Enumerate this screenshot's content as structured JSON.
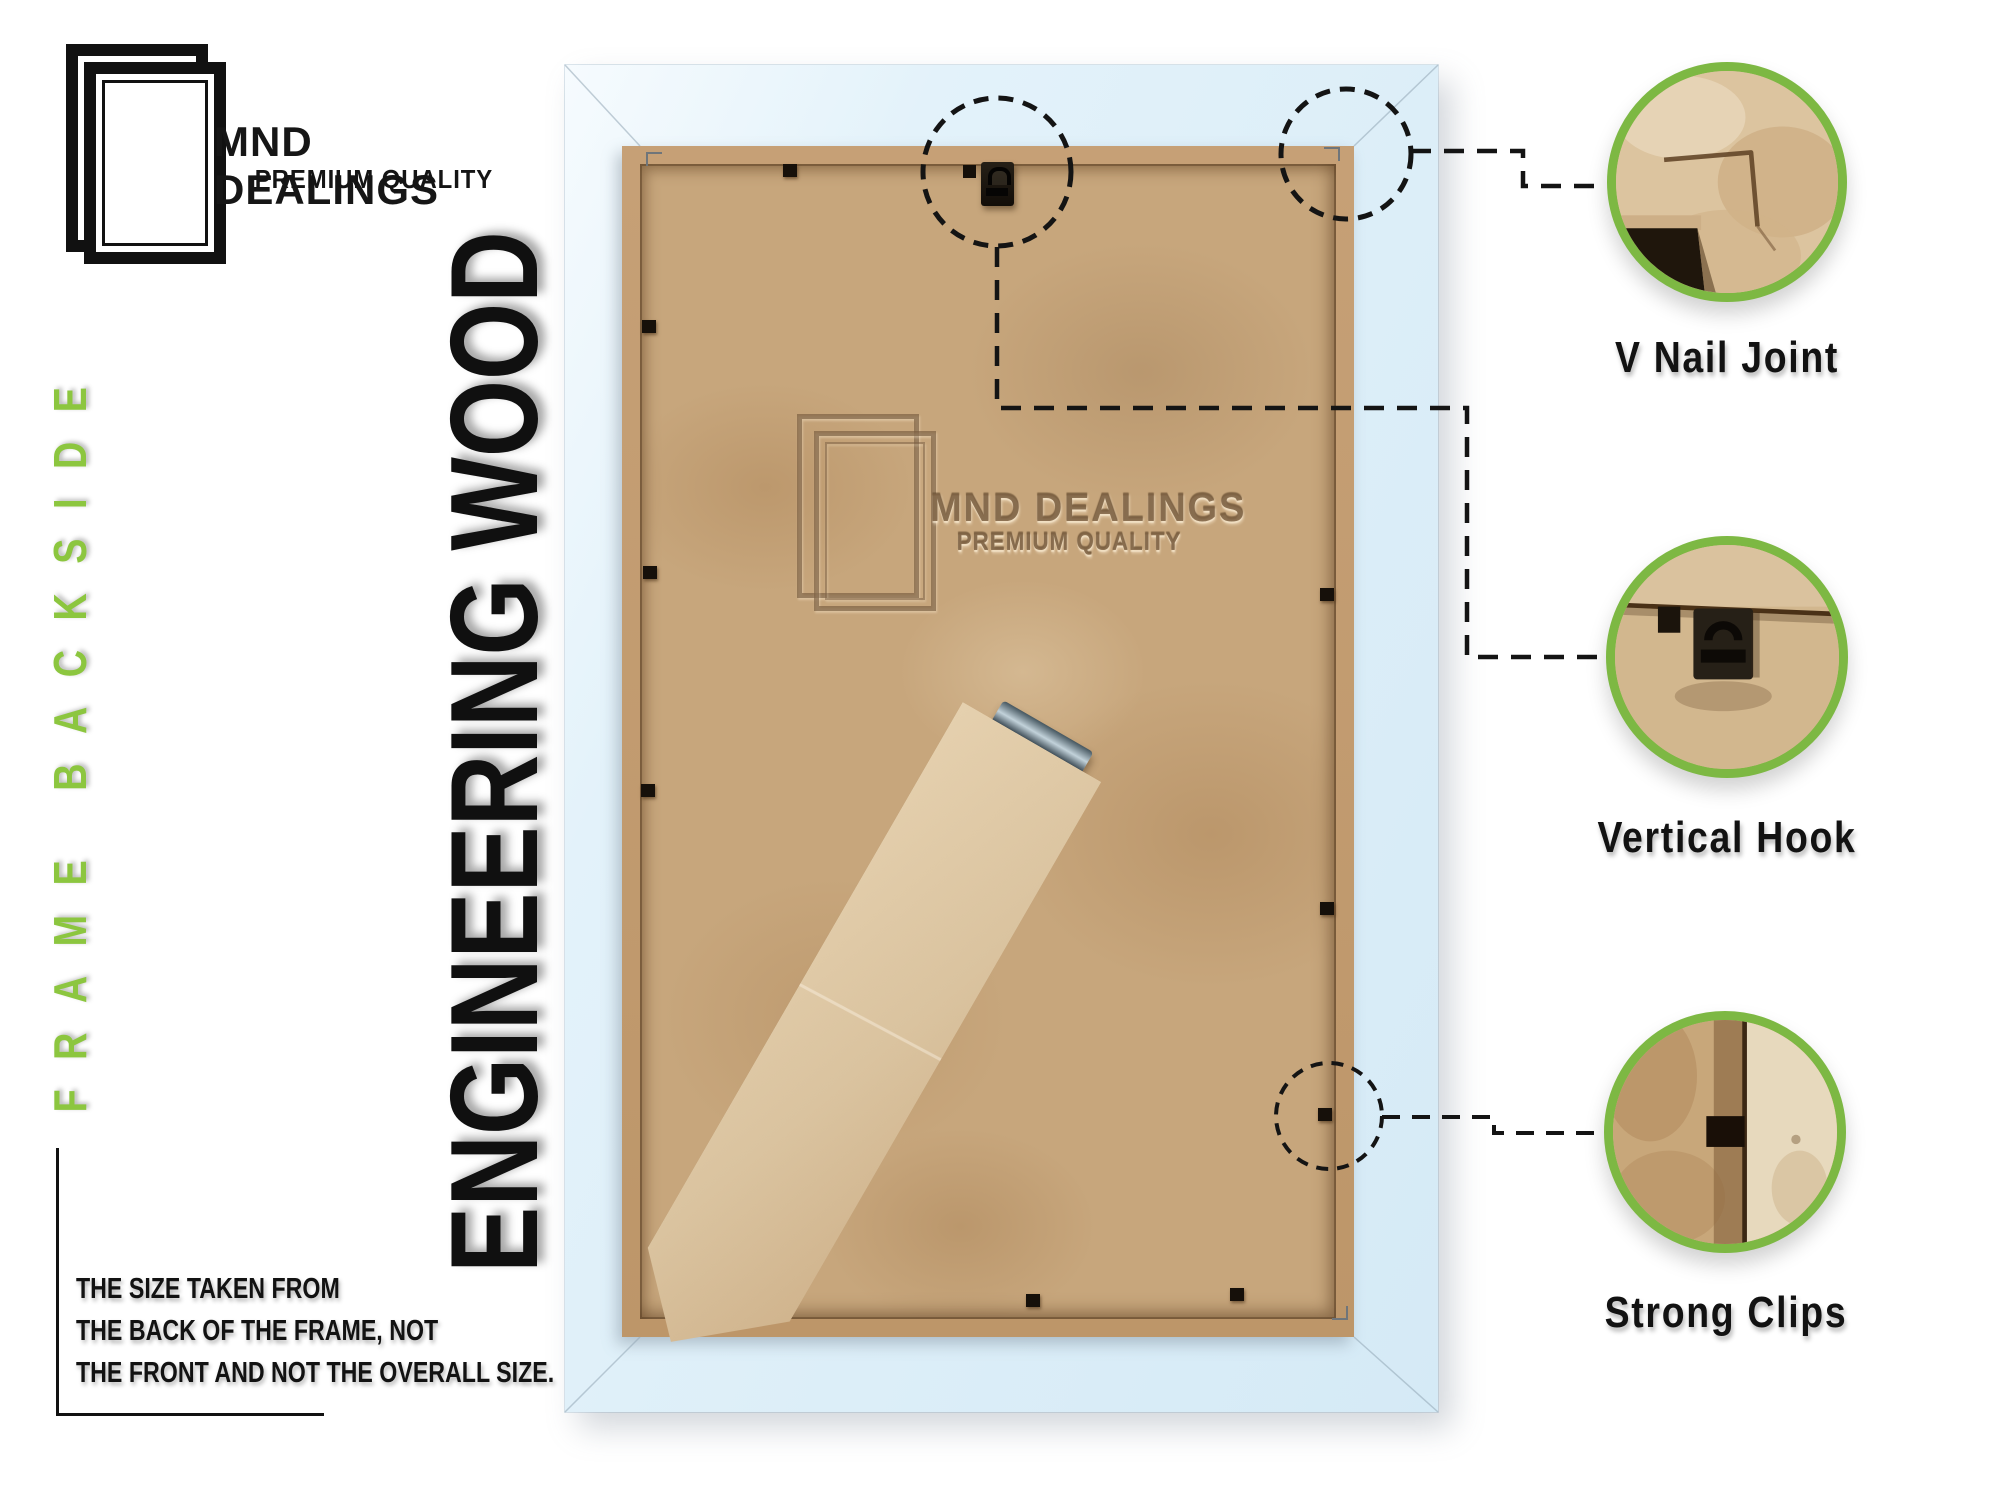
{
  "brand": {
    "name": "MND DEALINGS",
    "tagline": "PREMIUM QUALITY"
  },
  "side_label": "FRAME BACKSIDE",
  "material_label": "ENGINEERING WOOD",
  "watermark": {
    "name": "MND DEALINGS",
    "tagline": "PREMIUM QUALITY"
  },
  "size_note": {
    "line1": "THE SIZE TAKEN FROM",
    "line2": "THE BACK OF THE FRAME, NOT",
    "line3": "THE FRONT AND NOT THE OVERALL SIZE."
  },
  "callouts": [
    {
      "label": "V Nail Joint"
    },
    {
      "label": "Vertical Hook"
    },
    {
      "label": "Strong Clips"
    }
  ],
  "colors": {
    "accent_green": "#7DB843",
    "side_label_green": "#8CC63F",
    "frame_blue": "#DCEEF8",
    "mdf_tan": "#C7A67C",
    "ink": "#141414"
  }
}
